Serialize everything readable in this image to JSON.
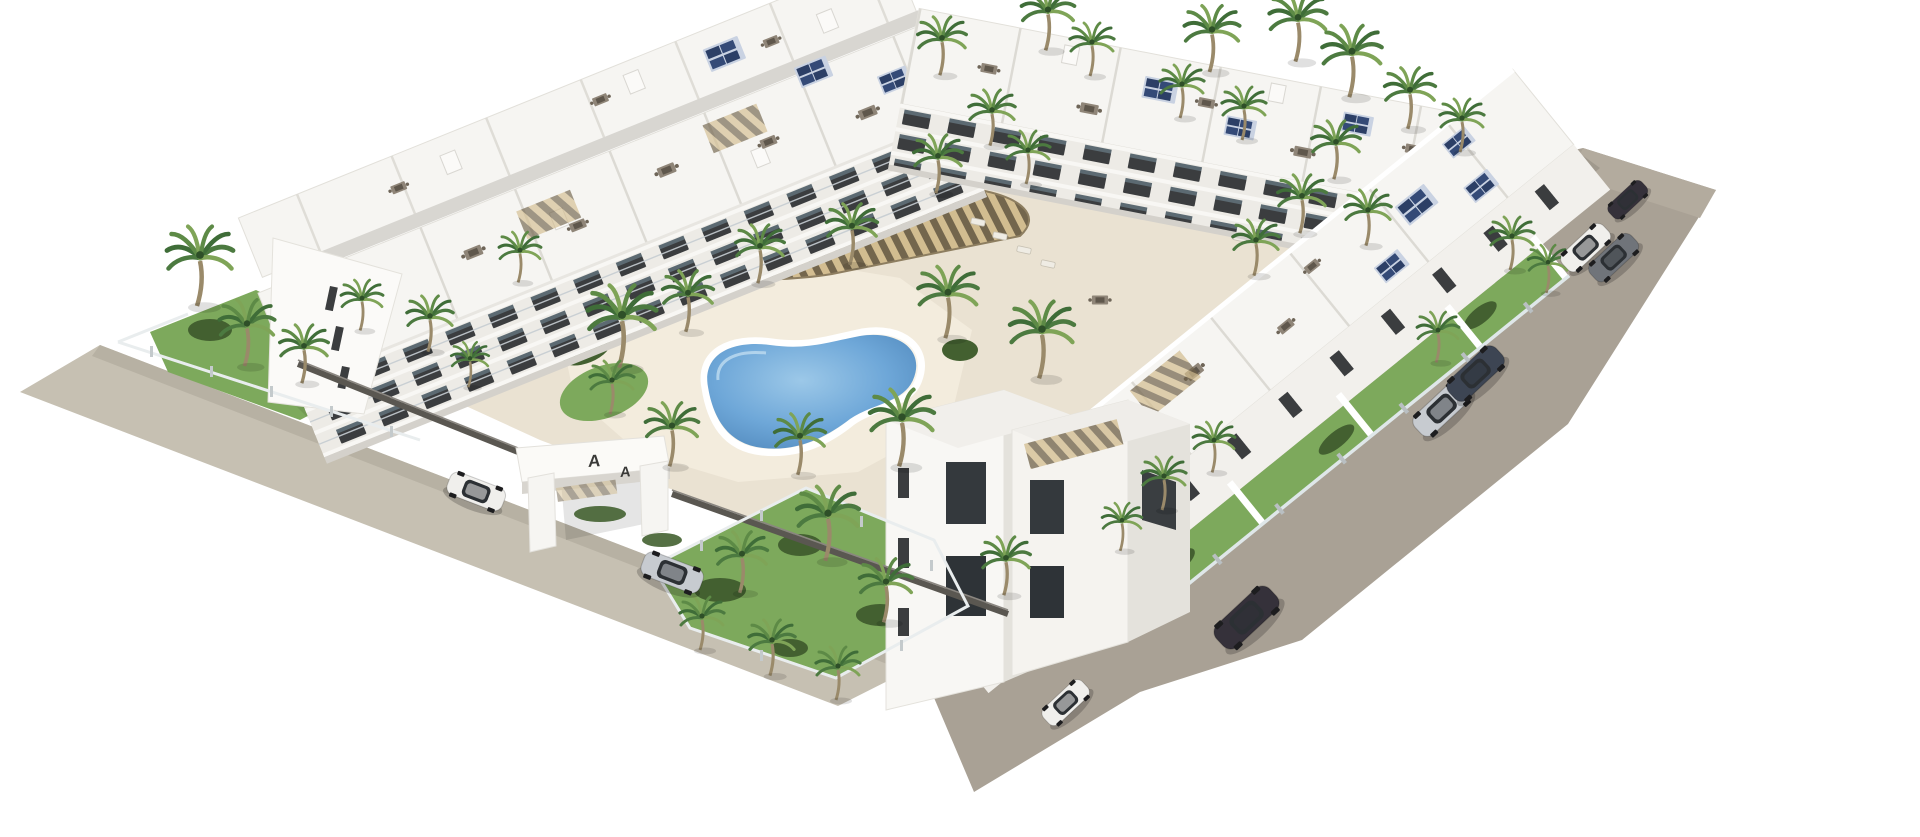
{
  "scene": {
    "title": "Aerial 3D architectural render of a white apartment complex",
    "type": "architectural-visualization",
    "setting": "Mediterranean resort-style residential development seen from above on a white background",
    "background": "#ffffff"
  },
  "colors": {
    "background": "#ffffff",
    "road": "#a9a195",
    "road_light": "#c6c0b2",
    "courtyard": "#eae2d2",
    "deck": "#f3ecdd",
    "grass": "#7da95c",
    "shrub": "#436030",
    "palm_dark": "#3f6d38",
    "palm_light": "#7fa457",
    "building_white": "#f6f5f2",
    "building_shade": "#edebe6",
    "building_dark_face": "#e4e2dc",
    "window": "#3b3d3f",
    "glass": "#8fa3ae",
    "pool_light": "#8fc0e4",
    "pool_deep": "#4e86ba",
    "pergola_wood": "#6f6148",
    "pergola_slat": "#d2bc8e",
    "solar": "#2c3f66",
    "fence_dark": "#5a5751",
    "fence_glass": "#e9edee",
    "car_white": "#f0efec",
    "car_silver": "#c7cbd0",
    "car_dark": "#35313a",
    "car_navy": "#3d4553",
    "car_gray": "#70747a"
  },
  "gate": {
    "mark_left": "A",
    "mark_right": "A"
  },
  "inventory": {
    "buildings": [
      {
        "name": "northwest-apartment-row",
        "floors": 3,
        "features": "balconies, roof terraces, solar panels"
      },
      {
        "name": "northeast-apartment-row",
        "floors": 3,
        "features": "roof terraces with dining sets, solar panels"
      },
      {
        "name": "southeast-apartment-row",
        "floors": 3,
        "features": "roof terraces, private walled gardens along road"
      },
      {
        "name": "south-corner-tower",
        "floors": 4,
        "features": "corner block with slit windows"
      }
    ],
    "pools": [
      {
        "name": "kidney-pool",
        "shape": "freeform",
        "location": "central courtyard"
      },
      {
        "name": "rectangular-pool",
        "shape": "rectangle",
        "location": "northeast courtyard"
      }
    ],
    "amenities": [
      "wood slat pergola",
      "sun loungers",
      "palm garden",
      "glass perimeter fence",
      "entrance portal marked A A"
    ],
    "vehicles": [
      {
        "name": "white-suv-at-entrance",
        "color_key": "car_white"
      },
      {
        "name": "silver-sedan-at-entrance",
        "color_key": "car_silver"
      },
      {
        "name": "white-hatchback-south-road",
        "color_key": "car_white"
      },
      {
        "name": "dark-suv-south-road",
        "color_key": "car_dark"
      },
      {
        "name": "silver-sedan-east-road",
        "color_key": "car_silver"
      },
      {
        "name": "navy-sedan-east-road",
        "color_key": "car_navy"
      },
      {
        "name": "white-suv-northeast-road",
        "color_key": "car_white"
      },
      {
        "name": "gray-suv-northeast-road",
        "color_key": "car_gray"
      },
      {
        "name": "dark-hatchback-northeast-road",
        "color_key": "car_dark"
      }
    ],
    "vegetation": {
      "palm_trees": 44,
      "hedges": true,
      "lawns": 6
    }
  }
}
